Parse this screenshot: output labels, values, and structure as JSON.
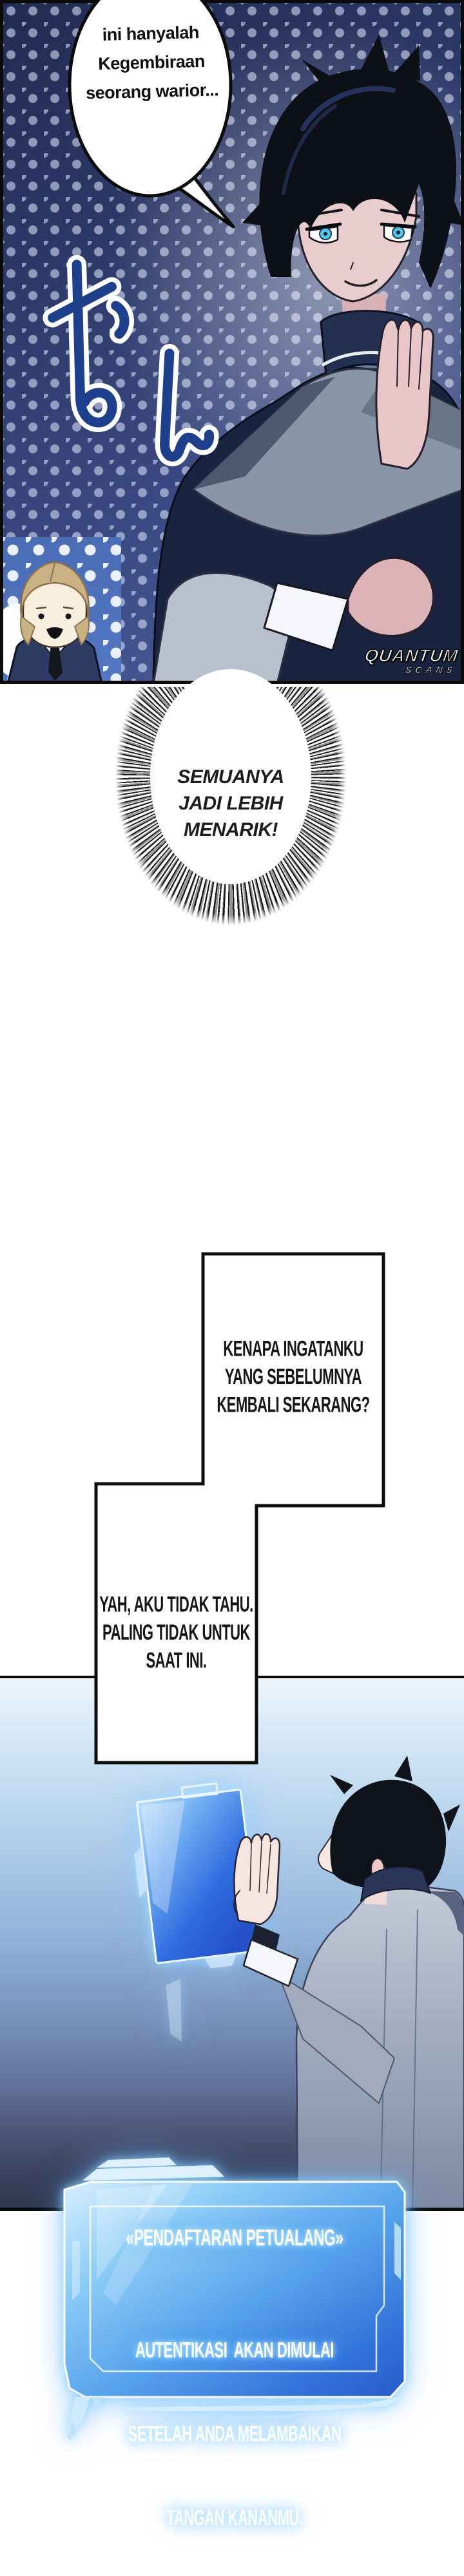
{
  "panel_top": {
    "speech_bubble": {
      "lines": [
        "ini hanyalah",
        "Kegembiraan",
        "seorang warior..."
      ]
    },
    "sfx_text": "むん",
    "watermark": {
      "line1": "QUANTUM",
      "line2": "SCANS"
    }
  },
  "shout_bubble": {
    "lines": [
      "SEMUANYA",
      "JADI LEBIH",
      "MENARIK!"
    ]
  },
  "caption_box_top": {
    "lines": [
      "KENAPA INGATANKU",
      "YANG SEBELUMNYA",
      "KEMBALI SEKARANG?"
    ]
  },
  "caption_box_bottom": {
    "lines": [
      "YAH, AKU TIDAK TAHU.",
      "PALING TIDAK UNTUK",
      "SAAT INI."
    ]
  },
  "system_window": {
    "title": "«PENDAFTARAN PETUALANG»",
    "lines": [
      "AUTENTIKASI  AKAN DIMULAI",
      "SETELAH ANDA MELAMBAIKAN",
      "TANGAN KANANMU."
    ]
  },
  "colors": {
    "panel_navy": "#2c3866",
    "dot": "#d2dcf2",
    "chibi_patch_blue": "#4b6db6",
    "sfx_blue": "#1d3f8c",
    "window_blue": "#3f8ae6",
    "window_glow": "#9fd8ff",
    "scene_top": "#eef6fc",
    "scene_bottom": "#303850",
    "ink": "#0b0b0b"
  }
}
